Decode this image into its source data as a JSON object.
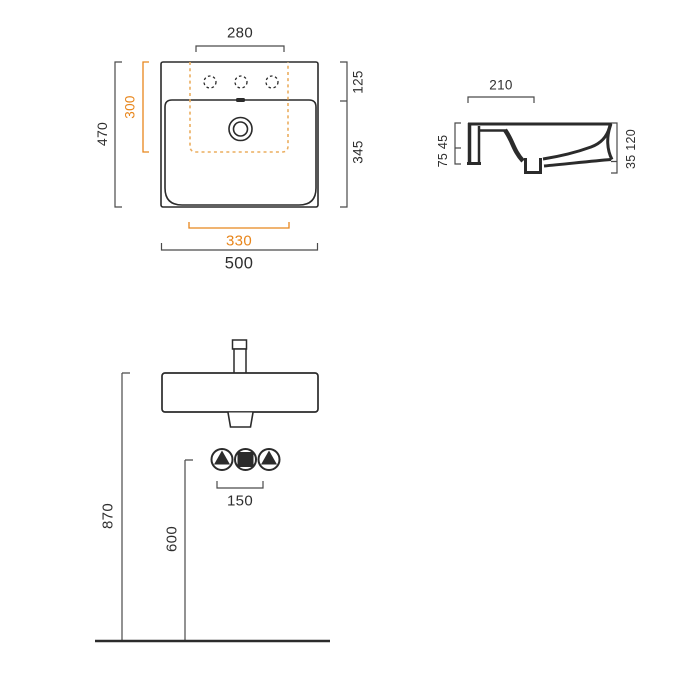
{
  "drawing": {
    "type": "washbasin-dimension-diagram",
    "views": {
      "top_view": "top-view",
      "side_view": "side-section-view",
      "front_view": "front-installation-view"
    }
  },
  "colors": {
    "ink": "#2b2b2b",
    "ink-text": "#2e2e2e",
    "dim": "#4a4a4a",
    "accent": "#e8861c",
    "accent-dash": "#ebad5e",
    "bg": "#ffffff"
  },
  "labels": {
    "d280": "280",
    "d470": "470",
    "d300": "300",
    "d125": "125",
    "d345": "345",
    "d330": "330",
    "d500": "500",
    "d210": "210",
    "d7545": "75 45",
    "d35120": "35 120",
    "d870": "870",
    "d600": "600",
    "d150": "150"
  },
  "icons": {
    "supply_valve": "triangle-in-circle",
    "waste_outlet": "square-in-circle",
    "faucet_hole": "dashed-circle",
    "drain": "concentric-circles"
  }
}
